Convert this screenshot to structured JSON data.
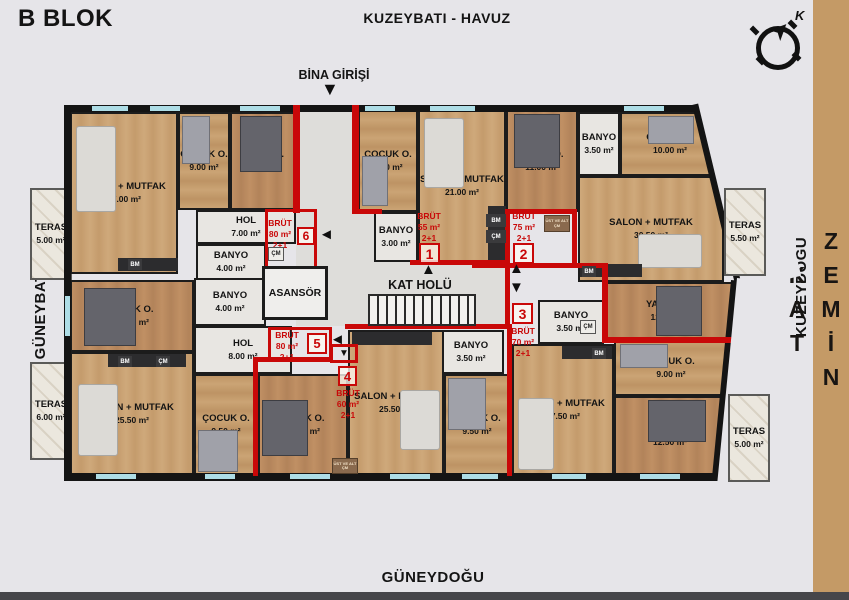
{
  "header": {
    "block": "B BLOK",
    "orientation_top": "KUZEYBATI - HAVUZ",
    "orientation_bottom": "GÜNEYDOĞU",
    "orientation_left": "GÜNEYBATI - YOL",
    "orientation_right": "KUZEYDOĞU",
    "floor": "ZEMİN KAT",
    "entrance": "BİNA GİRİŞİ",
    "compass": "K"
  },
  "core": {
    "elevator": "ASANSÖR",
    "hall": "KAT HOLÜ"
  },
  "icons": {
    "up": "▲",
    "down": "▼",
    "left": "◄"
  },
  "units": [
    {
      "no": "1",
      "brut_label": "BRÜT",
      "area": "55 m²",
      "plan": "2+1"
    },
    {
      "no": "2",
      "brut_label": "BRÜT",
      "area": "75 m²",
      "plan": "2+1"
    },
    {
      "no": "3",
      "brut_label": "BRÜT",
      "area": "70 m²",
      "plan": "2+1"
    },
    {
      "no": "4",
      "brut_label": "BRÜT",
      "area": "60 m²",
      "plan": "2+1"
    },
    {
      "no": "5",
      "brut_label": "BRÜT",
      "area": "80 m²",
      "plan": "2+1"
    },
    {
      "no": "6",
      "brut_label": "BRÜT",
      "area": "80 m²",
      "plan": "2+1"
    }
  ],
  "rooms": [
    {
      "name": "SALON + MUTFAK",
      "area": "27.00 m²"
    },
    {
      "name": "ÇOCUK O.",
      "area": "9.00 m²"
    },
    {
      "name": "YATAK O.",
      "area": "12.00 m²"
    },
    {
      "name": "HOL",
      "area": "7.00 m²"
    },
    {
      "name": "BANYO",
      "area": "4.00 m²"
    },
    {
      "name": "ÇOCUK O.",
      "area": "9.00 m²"
    },
    {
      "name": "SALON + MUTFAK",
      "area": "21.00 m²"
    },
    {
      "name": "YATAK O.",
      "area": "11.00 m²"
    },
    {
      "name": "BANYO",
      "area": "3.00 m²"
    },
    {
      "name": "BANYO",
      "area": "3.50 m²"
    },
    {
      "name": "ÇOCUK O.",
      "area": "10.00 m²"
    },
    {
      "name": "SALON + MUTFAK",
      "area": "30.50 m²"
    },
    {
      "name": "YATAK O.",
      "area": "12.00 m²"
    },
    {
      "name": "BANYO",
      "area": "3.50 m²"
    },
    {
      "name": "SALON + MUTFAK",
      "area": "27.50 m²"
    },
    {
      "name": "ÇOCUK O.",
      "area": "9.00 m²"
    },
    {
      "name": "YATAK O.",
      "area": "12.50 m²"
    },
    {
      "name": "BANYO",
      "area": "3.50 m²"
    },
    {
      "name": "YATAK O.",
      "area": "12.00 m²"
    },
    {
      "name": "SALON + MUTFAK",
      "area": "25.50 m²"
    },
    {
      "name": "ÇOCUK O.",
      "area": "9.50 m²"
    },
    {
      "name": "YATAK O.",
      "area": "13.50 m²"
    },
    {
      "name": "BANYO",
      "area": "4.00 m²"
    },
    {
      "name": "HOL",
      "area": "8.00 m²"
    },
    {
      "name": "SALON + MUTFAK",
      "area": "25.50 m²"
    },
    {
      "name": "ÇOCUK O.",
      "area": "9.50 m²"
    }
  ],
  "terraces": [
    {
      "name": "TERAS",
      "area": "5.00 m²"
    },
    {
      "name": "TERAS",
      "area": "6.00 m²"
    },
    {
      "name": "TERAS",
      "area": "5.50 m²"
    },
    {
      "name": "TERAS",
      "area": "5.00 m²"
    }
  ],
  "fixtures": {
    "bm": "BM",
    "cm": "ÇM",
    "note": "ÜST VE ALT ÇM"
  },
  "colors": {
    "accent_red": "#c90808",
    "sidebar": "#c49a66",
    "wall": "#141414",
    "window": "#aedde6",
    "background": "#e6e5e9"
  }
}
